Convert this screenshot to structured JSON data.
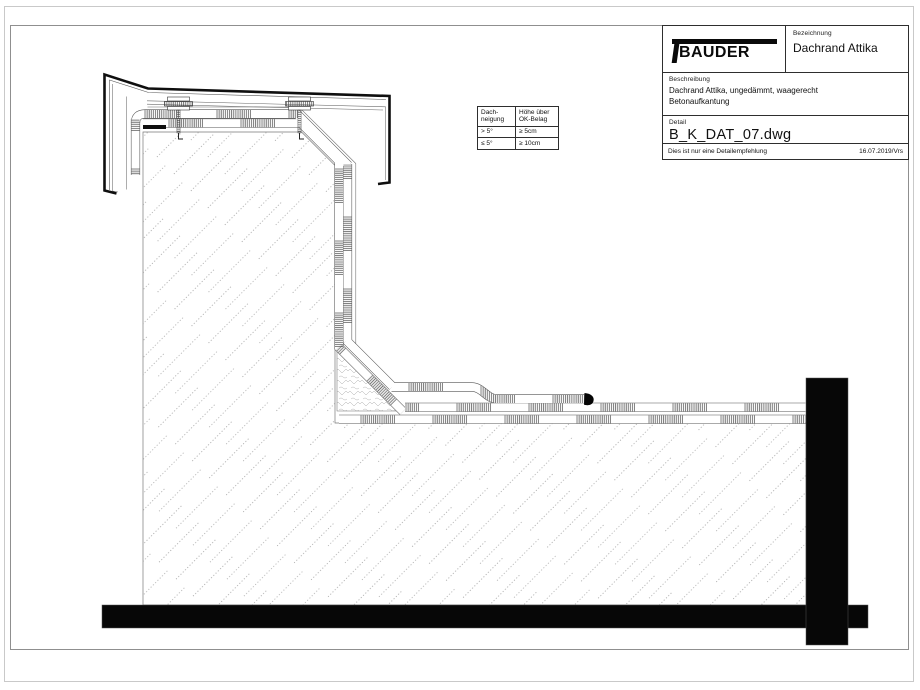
{
  "title_block": {
    "logo_text": "BAUDER",
    "bezeichnung_label": "Bezeichnung",
    "bezeichnung_value": "Dachrand Attika",
    "beschreibung_label": "Beschreibung",
    "beschreibung_line1": "Dachrand Attika, ungedämmt, waagerecht",
    "beschreibung_line2": "Betonaufkantung",
    "detail_label": "Detail",
    "detail_value": "B_K_DAT_07.dwg",
    "footer_note": "Dies ist nur eine Detailempfehlung",
    "footer_date": "16.07.2019/Vrs"
  },
  "slope_table": {
    "col1_line1": "Dach-",
    "col1_line2": "neigung",
    "col2_line1": "Höhe über",
    "col2_line2": "OK-Belag",
    "rows": [
      {
        "slope": "> 5°",
        "height": "≥ 5cm"
      },
      {
        "slope": "≤ 5°",
        "height": "≥ 10cm"
      }
    ]
  },
  "colors": {
    "line": "#0f0f0f",
    "concrete_hatch": "#909090",
    "membrane_hatch": "#4d4d4d",
    "frame": "#8f8f8f"
  }
}
